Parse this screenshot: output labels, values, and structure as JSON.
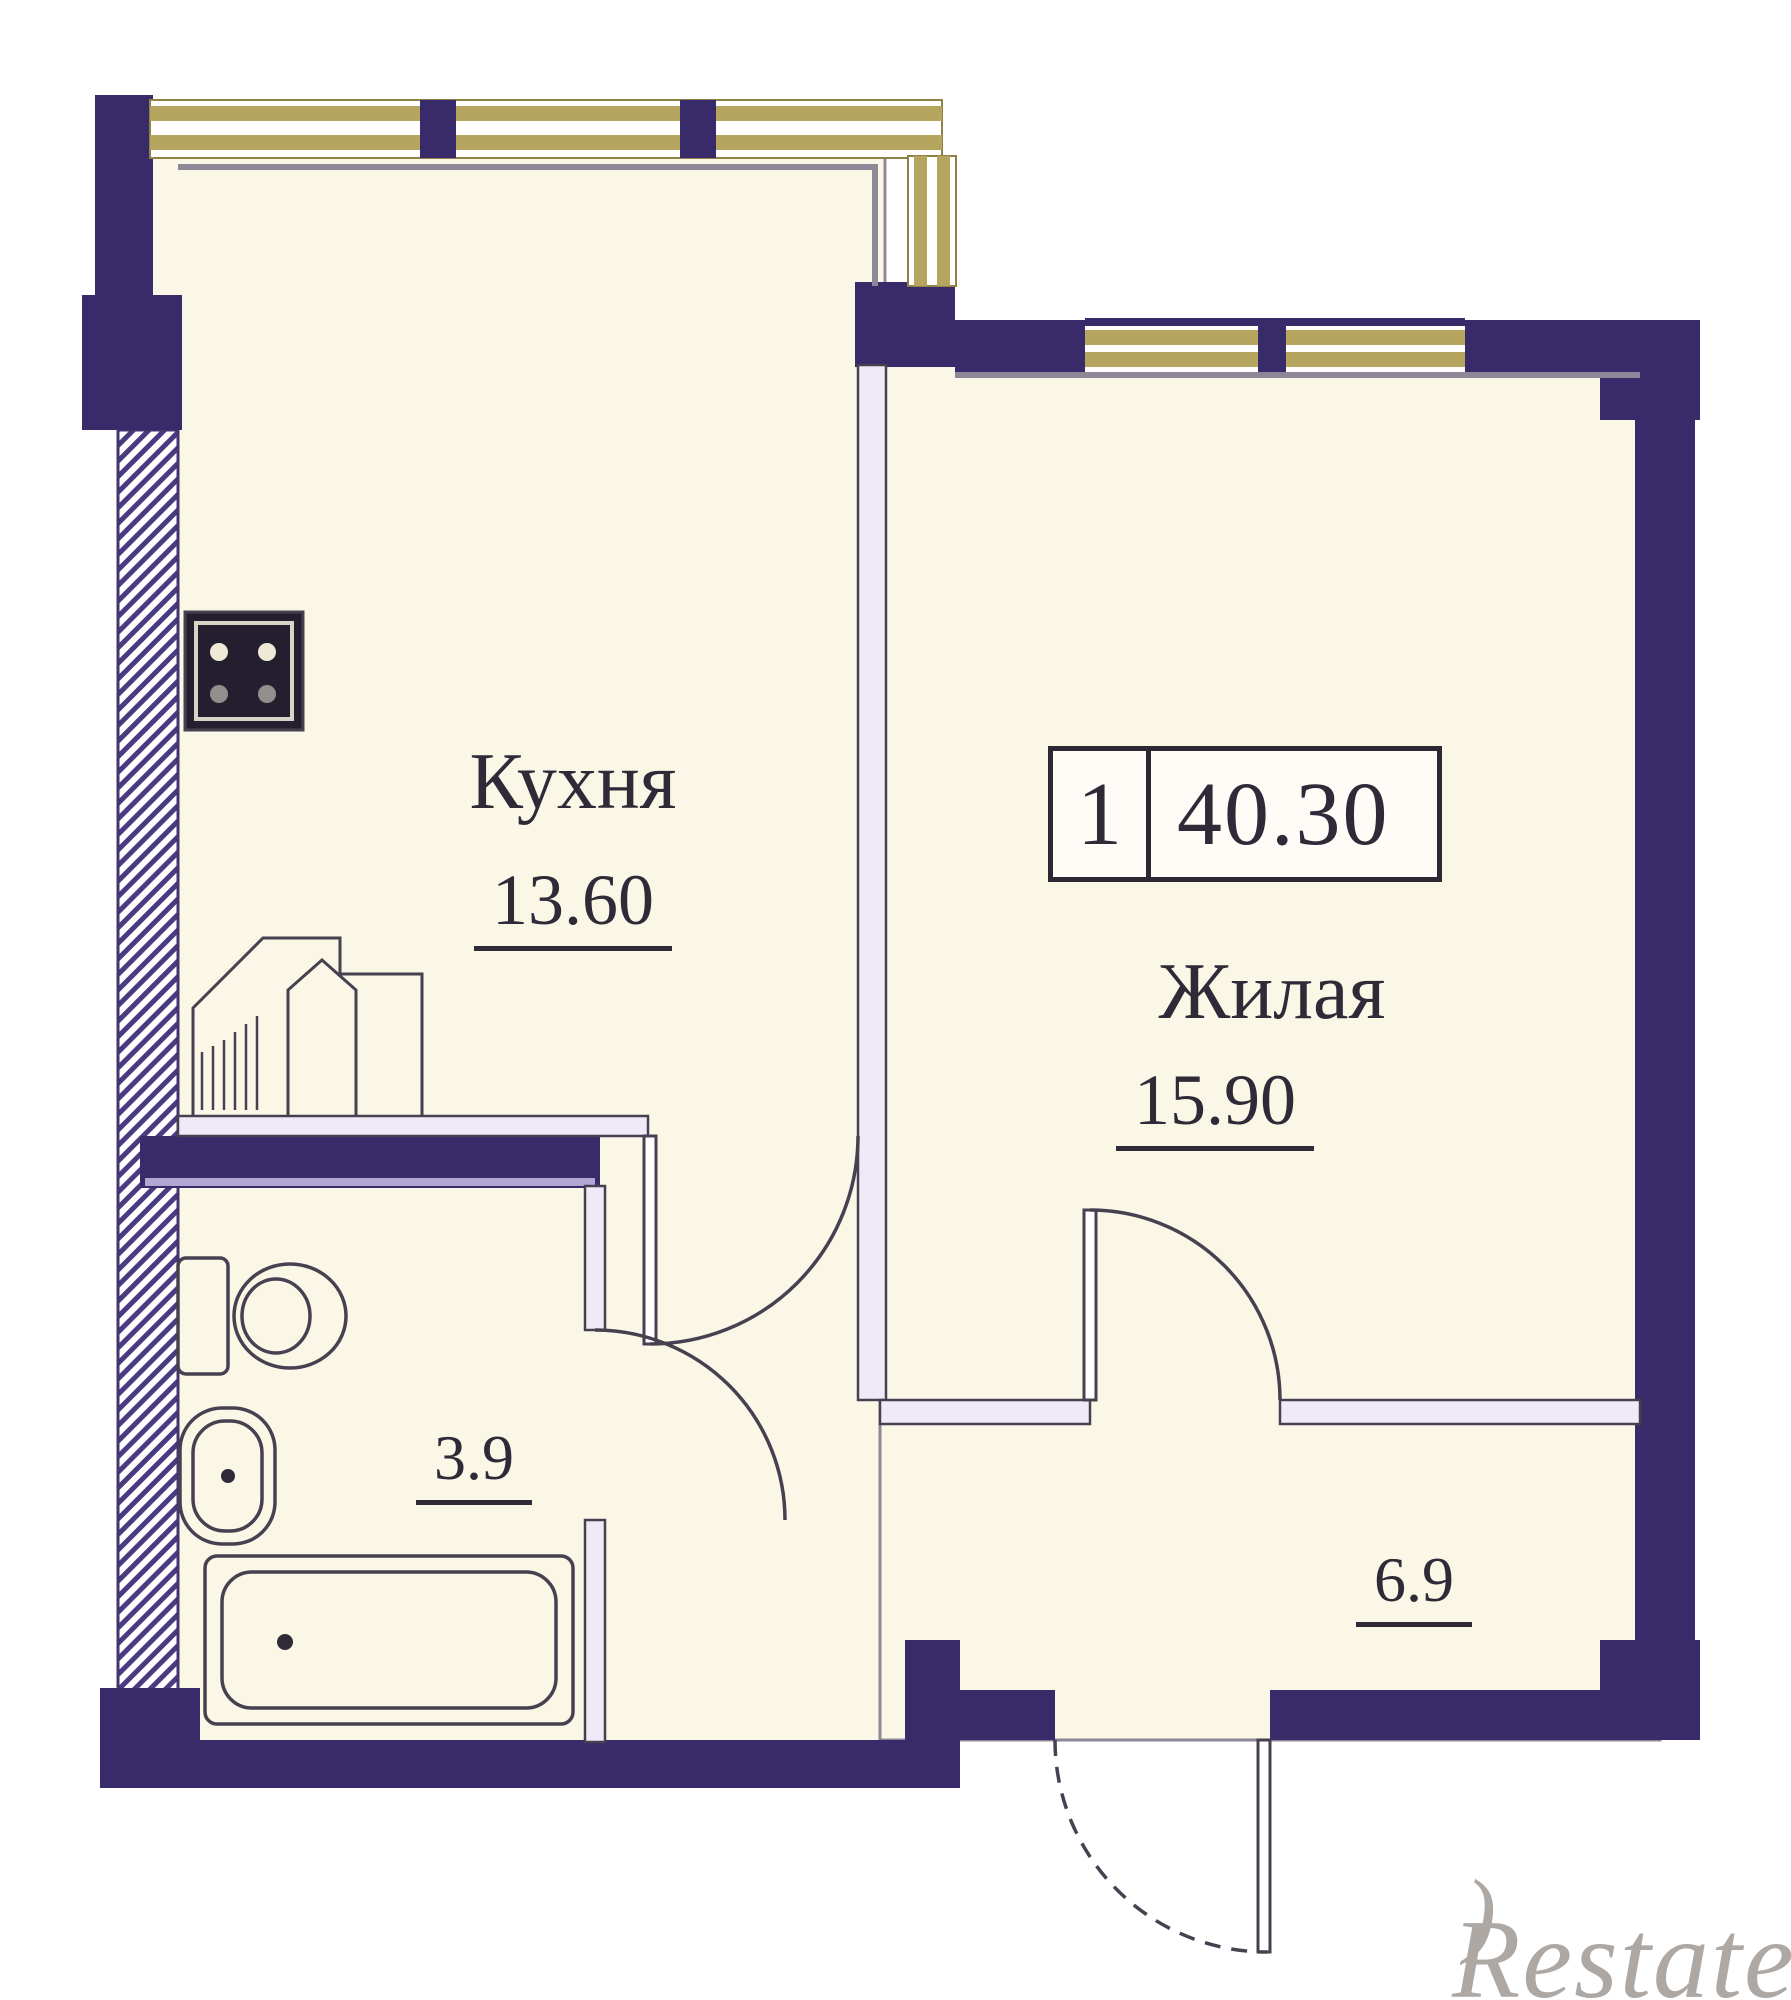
{
  "badge": {
    "rooms_count": "1",
    "total_area": "40.30"
  },
  "rooms": {
    "kitchen": {
      "label": "Кухня",
      "area": "13.60"
    },
    "living": {
      "label": "Жилая",
      "area": "15.90"
    },
    "bathroom": {
      "area": "3.9"
    },
    "hallway": {
      "area": "6.9"
    }
  },
  "watermark": {
    "r": "R",
    "mark": ")",
    "rest": "estate"
  },
  "colors": {
    "paper": "#ffffff",
    "wall": "#392a6a",
    "walllight": "#b3a6d4",
    "room": "#fbf7e7",
    "window": "#b5a55e",
    "windowedge": "#8f8245",
    "thinwall": "#efeaf7",
    "line": "#474050",
    "innerline": "#8d8798",
    "text": "#2f2a38",
    "watermark": "#9a938f"
  }
}
